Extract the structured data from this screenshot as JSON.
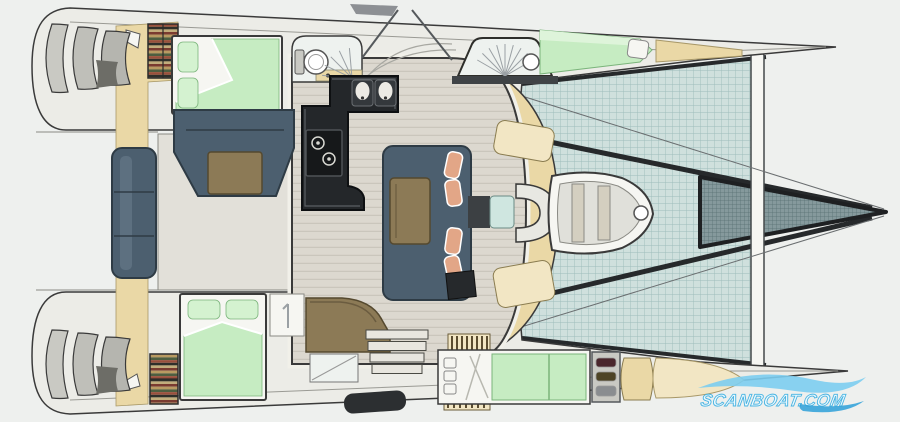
{
  "plan": {
    "type": "boat-floor-plan",
    "subject": "catamaran interior and deck layout, top-down view, stern at left and bow at right"
  },
  "watermark": {
    "text": "SCANBOAT.COM"
  },
  "colors": {
    "background": "#eef0ee",
    "hull_fill": "#ecece7",
    "hull_outline": "#3a3a3a",
    "deck_band": "#9a9a94",
    "floor": "#dcd8cf",
    "cockpit_floor": "#e2e0d9",
    "beige": "#ead8a6",
    "beige_light": "#f2e6c4",
    "bed_green": "#c6ecc2",
    "bed_green_light": "#def4da",
    "pillow_green": "#d4f2d0",
    "green_stroke": "#7bb47b",
    "slate": "#4c5f6f",
    "slate_dark": "#2e3b45",
    "slate_light": "#5d7080",
    "brown": "#8c7a56",
    "brown_dark": "#55492f",
    "salmon": "#e2a687",
    "counter": "#24272a",
    "counter_rim": "#5a5f63",
    "steel": "#c9c9c3",
    "white": "#f6f6f2",
    "glass": "#eef2ef",
    "tramp_base": "#cfe0dd",
    "tramp_line": "#9dbcba",
    "trampdark_base": "#85999c",
    "trampdark_line": "#566e71",
    "beam_dark": "#26292b",
    "book1": "#7a3b30",
    "book2": "#b89a62",
    "book3": "#4e5e40",
    "book4": "#99503c",
    "book5": "#2f2f2a",
    "book6": "#c2ad7c",
    "watermark_light": "#7ccdf0",
    "watermark_dark": "#2da0d8",
    "watermark_text": "#eaf8fe",
    "watermark_text_stroke": "#49b4e2"
  }
}
